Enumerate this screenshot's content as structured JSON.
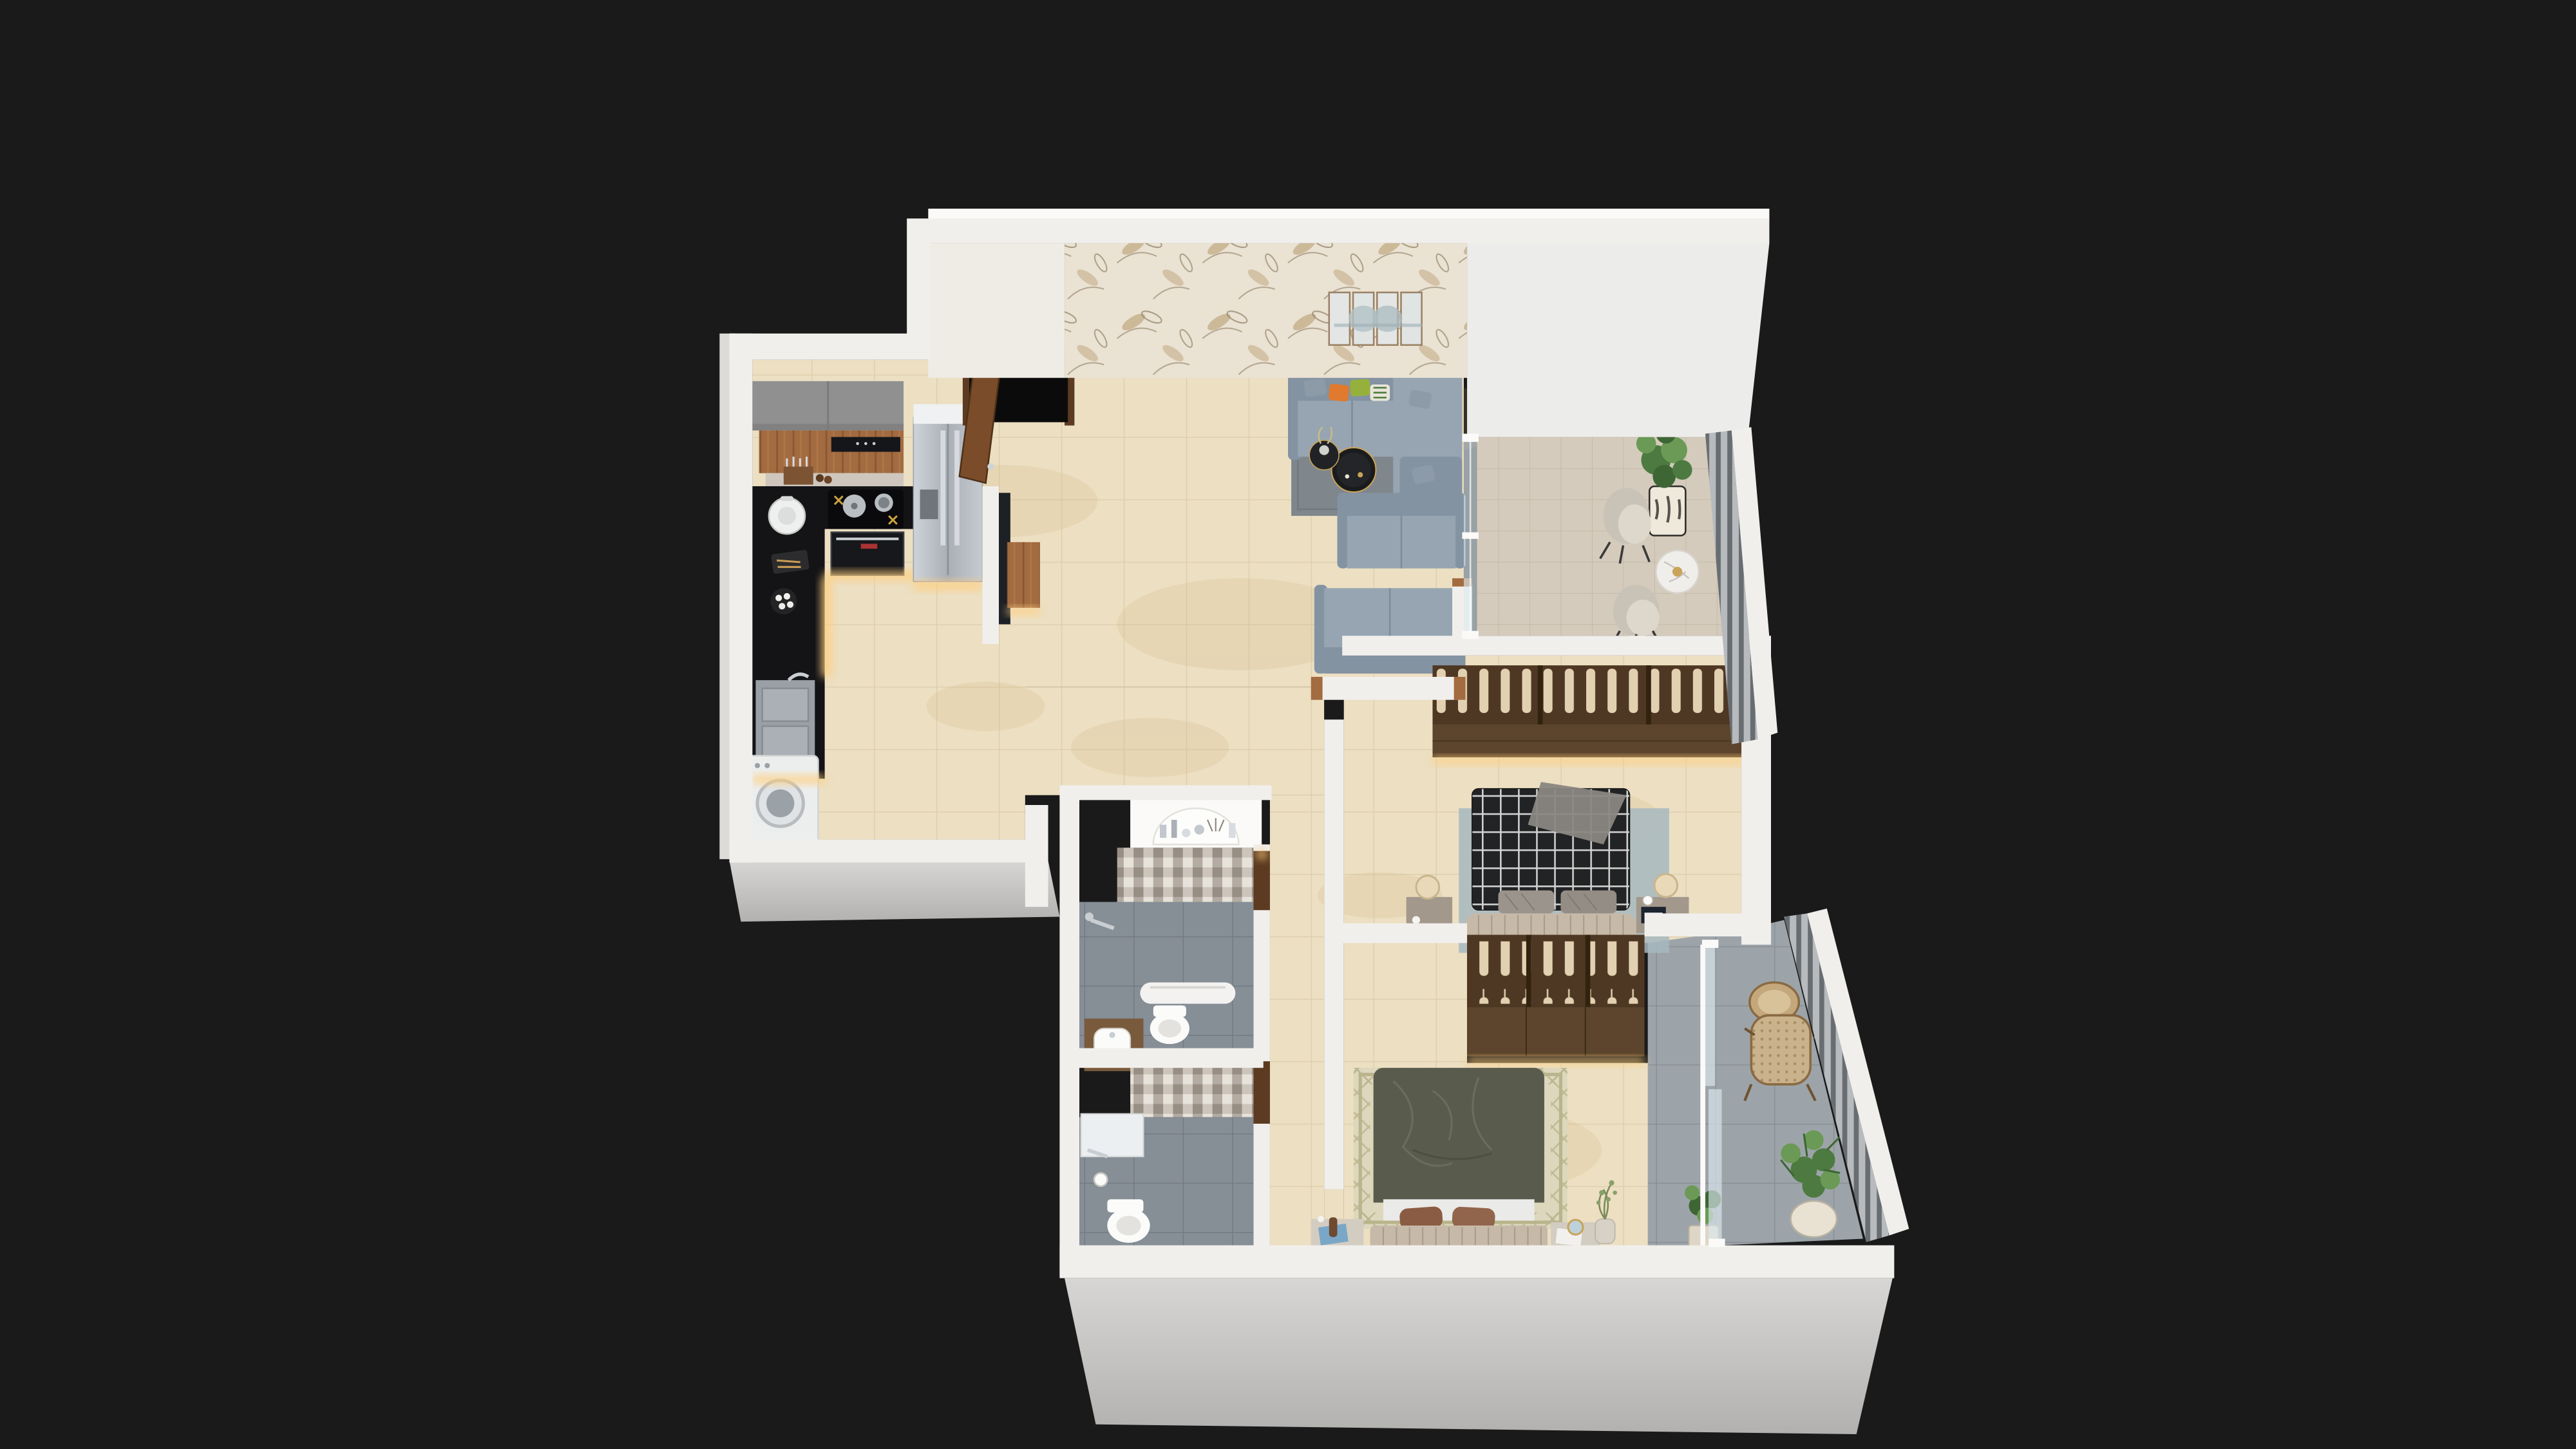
{
  "scene": {
    "type": "isometric-3d-floor-plan",
    "background": "#1a1a1a",
    "rooms": [
      "kitchen",
      "entry",
      "living-room",
      "living-balcony",
      "hallway",
      "bathroom-1",
      "bathroom-2",
      "bedroom-1",
      "bedroom-2",
      "bedroom-balcony"
    ]
  },
  "palette": {
    "bg": "#1a1a1a",
    "wall": "#f1efec",
    "wall_bright": "#fbfaf8",
    "wall_face": "#ececea",
    "wall_shade": "#dcdbd8",
    "slab_light": "#d7d6d4",
    "slab_dark": "#b2b1af",
    "cream_wall": "#efece5",
    "wallpaper_base": "#eae2d3",
    "wallpaper_leaf": "#bfa87f",
    "wallpaper_stem": "#8d7c60",
    "floor_beige": "#ecdfc2",
    "floor_grout": "#d8c8a4",
    "floor_stain": "#caa86f",
    "bath_tile": "#868e96",
    "bath_grout": "#71787f",
    "balcony1_tile": "#d4cbbc",
    "balcony1_grout": "#c3b9a8",
    "balcony2_tile": "#9da4a9",
    "balcony2_grout": "#868d92",
    "wood": "#a26b40",
    "wood_dark": "#5c3b22",
    "door_wood": "#7a4c2a",
    "cab_gray": "#909090",
    "counter_black": "#141417",
    "steel": "#c3c8ce",
    "sofa": "#97a5b2",
    "sofa_dark": "#8493a2",
    "rug": "#79828a",
    "accent_orange": "#df7a2e",
    "accent_green": "#96b13b",
    "wardrobe_box": "#4e3824",
    "wardrobe_front": "#5c452c",
    "clothes": "#ead9b8",
    "plaid_base": "#222325",
    "bed2": "#595c4d",
    "headboard": "#c6b9a8",
    "mattress": "#eaeae8",
    "rug1": "#a7b8c0",
    "rug2": "#dcd7bd",
    "rug2_line": "#b9b48b",
    "mosaic_a": "#cdc5bb",
    "mosaic_b": "#978e84",
    "mosaic_c": "#e7e2da",
    "mosaic_d": "#b4aca2",
    "porcelain": "#fbfbfa",
    "led": "#ffcf7e",
    "glass": "#dceaf0",
    "rail": "#b7bbbe",
    "rail_slat": "#5f6468",
    "plant": "#4d7a40",
    "plant_light": "#6a9a55",
    "plant_dark": "#3e6634",
    "cane": "#c9b28c",
    "cane_dot": "#a98f68",
    "marble": "#f0eeea",
    "gold": "#c9a45a"
  }
}
